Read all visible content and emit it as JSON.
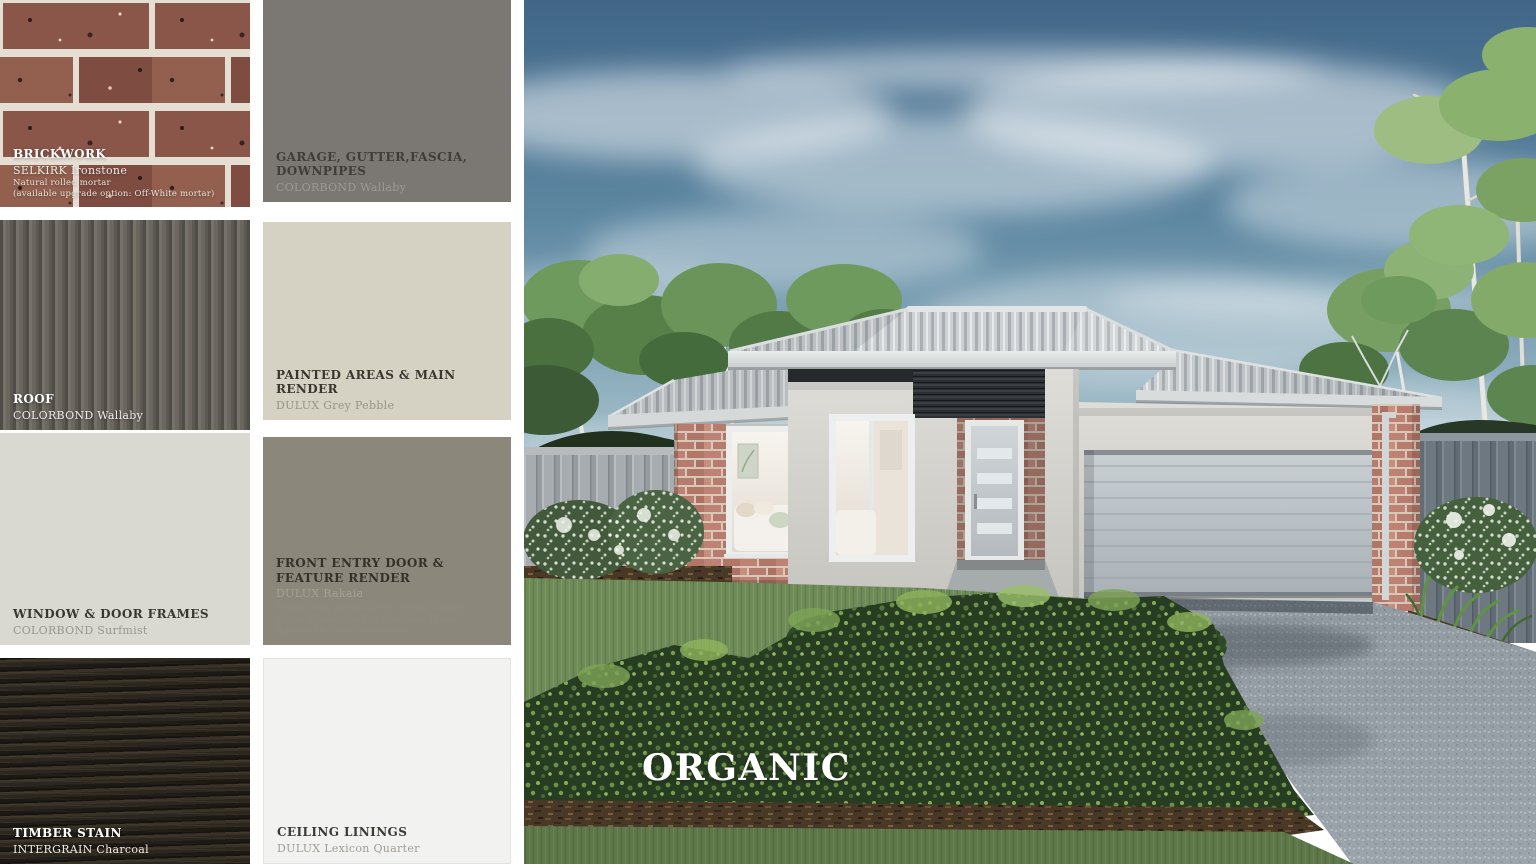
{
  "board": {
    "scheme_name": "ORGANIC",
    "background_color": "#ffffff"
  },
  "swatches": [
    {
      "id": "brickwork",
      "title": "BRICKWORK",
      "subtitle": "SELKIRK Ironstone",
      "line2": "Natural rolled mortar",
      "line3": "(available upgrade option: Off-White mortar)",
      "color": "#8a5649",
      "mortar_color": "#e5ded2",
      "texture": "brick"
    },
    {
      "id": "garage-gutter-fascia-downpipes",
      "title": "GARAGE, GUTTER,FASCIA, DOWNPIPES",
      "subtitle": "COLORBOND Wallaby",
      "color": "#7b7772",
      "texture": "plain"
    },
    {
      "id": "roof",
      "title": "ROOF",
      "subtitle": "COLORBOND Wallaby",
      "color": "#6b675f",
      "texture": "corrugated"
    },
    {
      "id": "painted-areas-main-render",
      "title": "PAINTED AREAS & MAIN RENDER",
      "subtitle": "DULUX Grey Pebble",
      "color": "#d5d1c3",
      "texture": "plain"
    },
    {
      "id": "window-door-frames",
      "title": "WINDOW & DOOR FRAMES",
      "subtitle": "COLORBOND Surfmist",
      "color": "#dad9d1",
      "texture": "plain"
    },
    {
      "id": "front-entry-door-feature-render",
      "title": "FRONT ENTRY DOOR &",
      "title2": "FEATURE RENDER",
      "subtitle": "DULUX Rakaia",
      "note": "Render only applicable to specific facade styles. Please speak to your New Home Advisor for more information.",
      "color": "#8b877a",
      "texture": "plain"
    },
    {
      "id": "timber-stain",
      "title": "TIMBER STAIN",
      "subtitle": "INTERGRAIN Charcoal",
      "color": "#2b2720",
      "texture": "wood-grain"
    },
    {
      "id": "ceiling-linings",
      "title": "CEILING LININGS",
      "subtitle": "DULUX Lexicon Quarter",
      "color": "#f2f2f0",
      "texture": "plain"
    }
  ],
  "render": {
    "scheme_label": "ORGANIC",
    "colors": {
      "sky": "#5d87a1",
      "roof_metal": "#cdd1d3",
      "render_wall": "#d5d4cf",
      "brick": "#bd8273",
      "charcoal_feature": "#2c3034",
      "garage_door": "#b9c0c5",
      "front_door": "#c6cbcf",
      "fence_left": "#a7acb0",
      "fence_right": "#6e7880",
      "lawn": "#6d8a58",
      "hedge": "#263d22",
      "driveway": "#99a1a8"
    }
  }
}
